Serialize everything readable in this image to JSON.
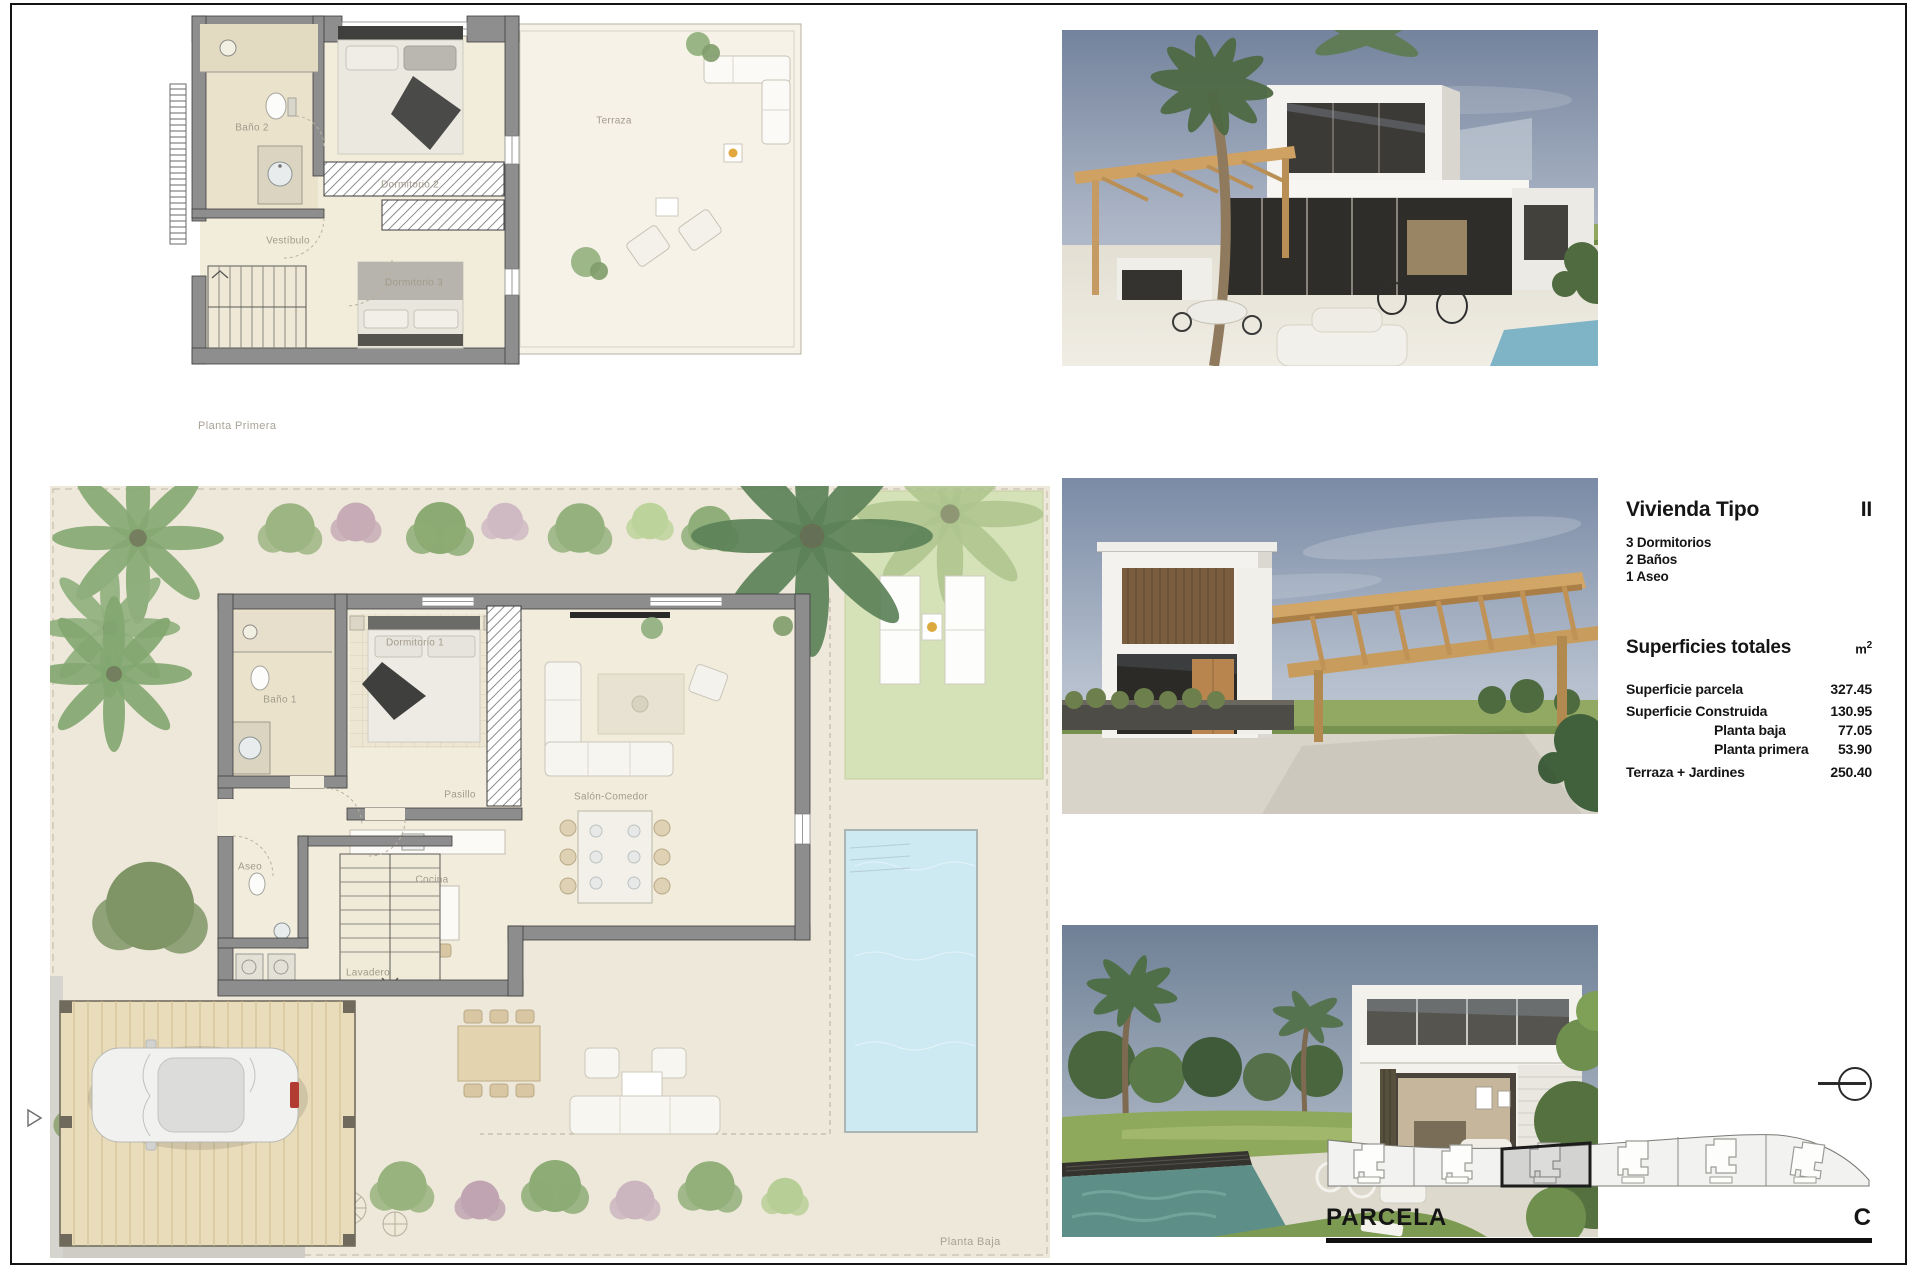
{
  "page": {
    "frame_color": "#141414"
  },
  "plans": {
    "first_floor": {
      "caption": "Planta Primera",
      "rooms": {
        "bano2": "Baño 2",
        "vestibulo": "Vestíbulo",
        "dormitorio2": "Dormitorio 2",
        "dormitorio3": "Dormitorio 3",
        "terraza": "Terraza"
      }
    },
    "ground_floor": {
      "caption": "Planta Baja",
      "rooms": {
        "bano1": "Baño 1",
        "dormitorio1": "Dormitorio 1",
        "pasillo": "Pasillo",
        "salon": "Salón-Comedor",
        "aseo": "Aseo",
        "cocina": "Cocina",
        "lavadero": "Lavadero"
      }
    }
  },
  "info_panel": {
    "title": "Vivienda Tipo",
    "type_code": "II",
    "features": [
      "3 Dormitorios",
      "2 Baños",
      "1 Aseo"
    ],
    "surfaces_title": "Superficies totales",
    "surfaces_unit": "m",
    "surfaces_unit_exp": "2",
    "rows": [
      {
        "label": "Superficie parcela",
        "value": "327.45"
      },
      {
        "label": "Superficie Construida",
        "value": "130.95"
      },
      {
        "label": "Planta baja",
        "value": "77.05"
      },
      {
        "label": "Planta primera",
        "value": "53.90"
      },
      {
        "label": "Terraza + Jardines",
        "value": "250.40"
      }
    ]
  },
  "parcel": {
    "label": "PARCELA",
    "code": "C"
  },
  "palette": {
    "pool": "#cde9f2",
    "lawn": "#d5e1b6",
    "wall": "#8d8d8d",
    "wood": "#e9dcba",
    "sky": "#8394ad"
  }
}
